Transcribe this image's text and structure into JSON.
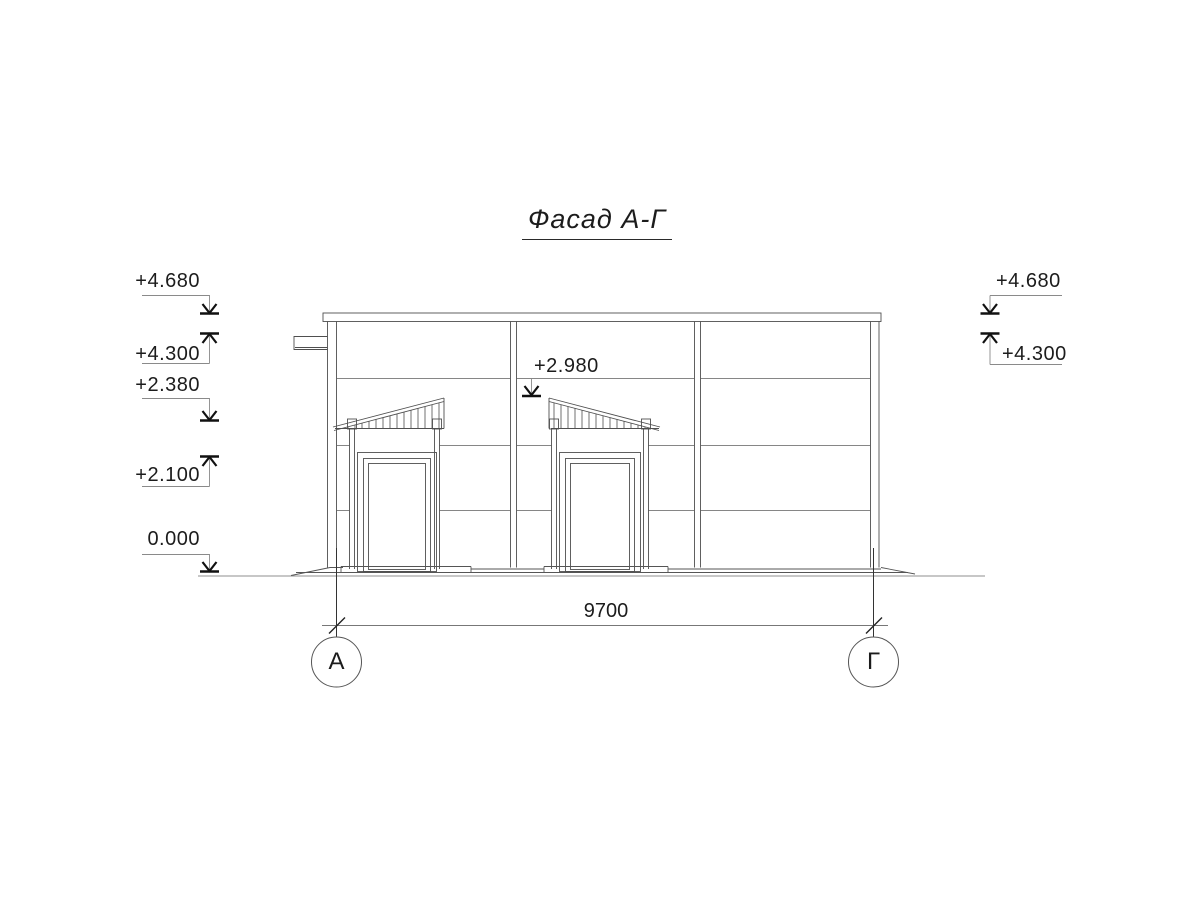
{
  "drawing": {
    "title": "Фасад А-Г",
    "levels_left": [
      "+4.680",
      "+4.300",
      "+2.380",
      "+2.100",
      "0.000"
    ],
    "levels_right": [
      "+4.680",
      "+4.300"
    ],
    "level_center": "+2.980",
    "dimension_width": "9700",
    "axes": [
      "А",
      "Г"
    ]
  },
  "colors": {
    "background": "#ffffff",
    "line": "#4f4f4f",
    "joint_line": "#5f5f5f",
    "marker": "#111111",
    "text": "#1c1c1c"
  }
}
